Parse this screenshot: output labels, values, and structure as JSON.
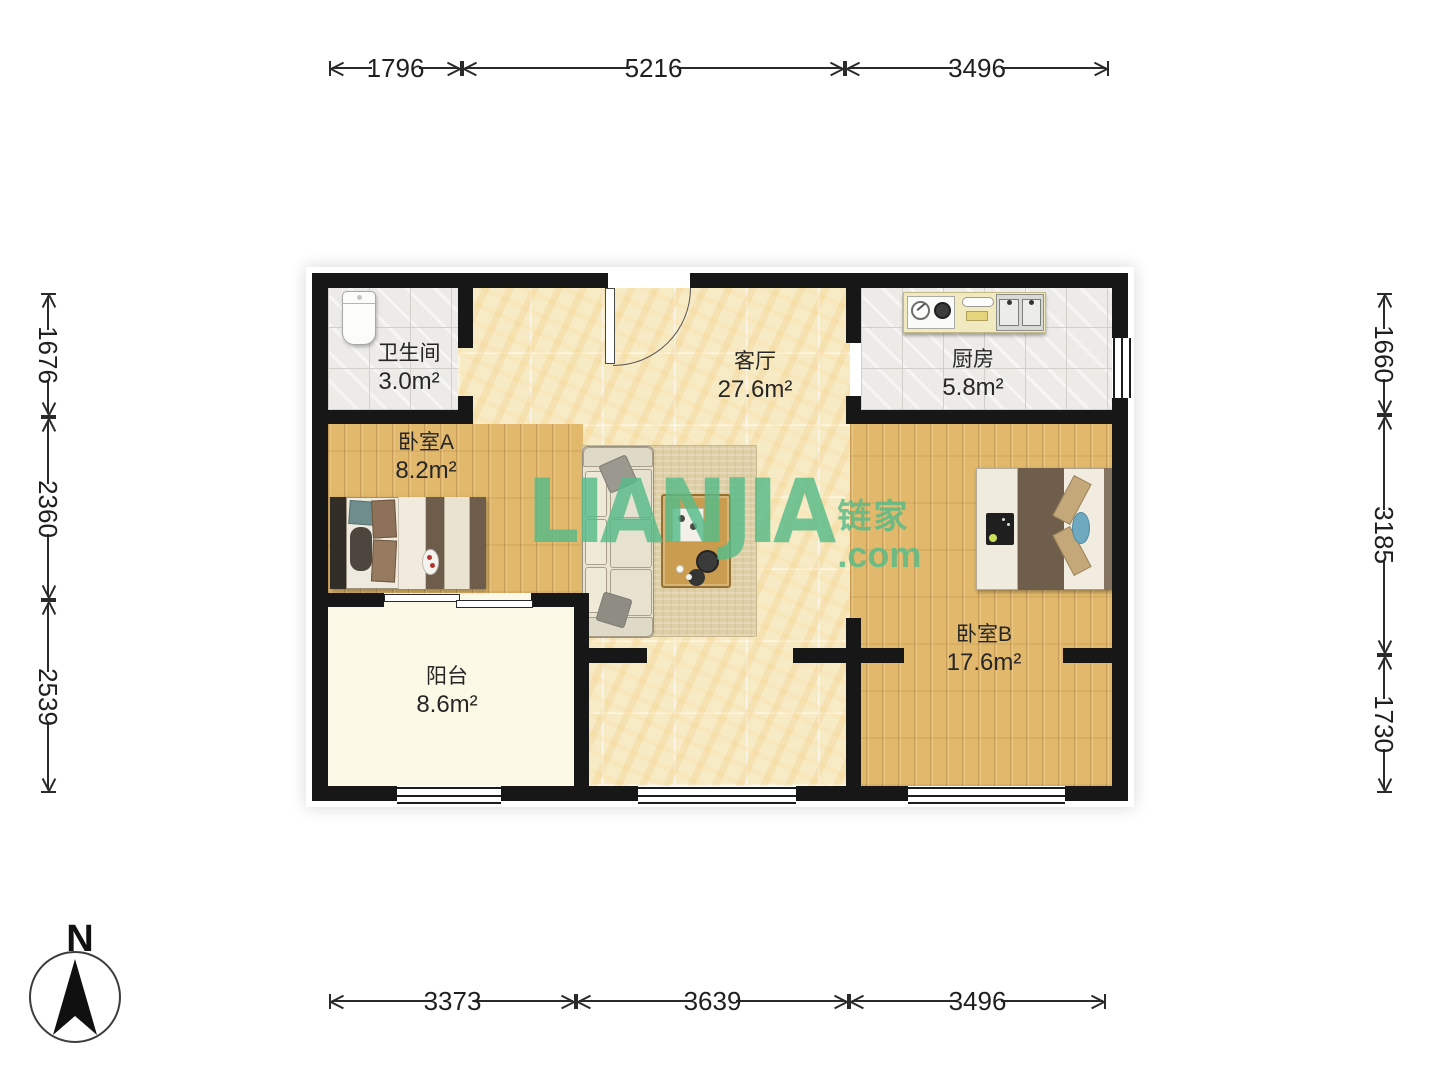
{
  "watermark": {
    "latin": "LIANJIA",
    "cjk": "链家",
    "tld": ".com",
    "brand_green": "#57BB89"
  },
  "compass": {
    "north_label": "N"
  },
  "rooms": {
    "bathroom": {
      "name": "卫生间",
      "area": "3.0m²"
    },
    "living": {
      "name": "客厅",
      "area": "27.6m²"
    },
    "kitchen": {
      "name": "厨房",
      "area": "5.8m²"
    },
    "bedroom_a": {
      "name": "卧室A",
      "area": "8.2m²"
    },
    "bedroom_b": {
      "name": "卧室B",
      "area": "17.6m²"
    },
    "balcony": {
      "name": "阳台",
      "area": "8.6m²"
    }
  },
  "dimensions_mm": {
    "top": [
      "1796",
      "5216",
      "3496"
    ],
    "bottom": [
      "3373",
      "3639",
      "3496"
    ],
    "left": [
      "1676",
      "2360",
      "2539"
    ],
    "right": [
      "1660",
      "3185",
      "1730"
    ]
  },
  "colors": {
    "wall": "#171717",
    "wood": "#E2B96C",
    "marble": "#F7EBC6",
    "tile": "#ECEBE7",
    "balcony": "#FCFAE6"
  }
}
